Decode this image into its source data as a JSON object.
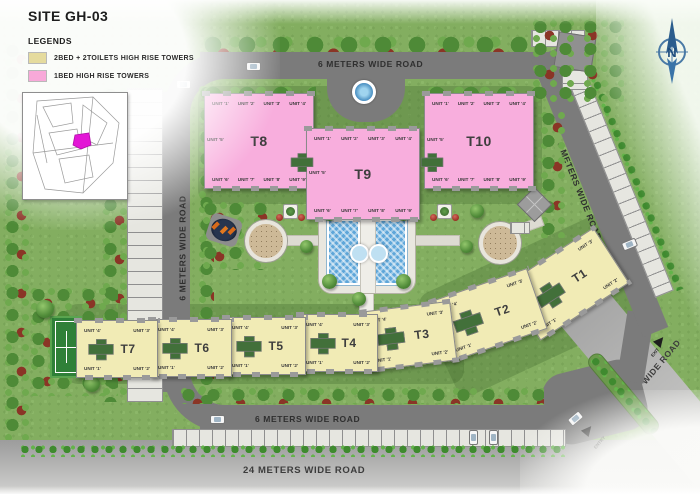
{
  "title": "SITE GH-03",
  "legend": {
    "heading": "LEGENDS",
    "items": [
      {
        "label": "2BED + 2TOILETS HIGH RISE TOWERS",
        "color": "#e5db9e"
      },
      {
        "label": "1BED  HIGH RISE TOWERS",
        "color": "#f8a9d9"
      }
    ]
  },
  "compass": {
    "label": "N"
  },
  "roads": {
    "top_label": "6 METERS WIDE ROAD",
    "left_label": "6 METERS WIDE ROAD",
    "right_label": "6 METERS WIDE ROAD",
    "inner_bottom_label": "6 METERS WIDE ROAD",
    "outer_bottom_label": "24 METERS WIDE ROAD",
    "outer_right_label": "24 METERS WIDE ROAD"
  },
  "gate": {
    "entry_label": "ENTRY",
    "exit_label": "EXIT"
  },
  "unit_labels": {
    "pink_top": [
      "UNIT '1'",
      "UNIT '2'",
      "UNIT '3'",
      "UNIT '4'"
    ],
    "pink_bottom": [
      "UNIT '6'",
      "UNIT '7'",
      "UNIT '8'",
      "UNIT '9'"
    ],
    "pink_side": "UNIT '5'",
    "yellow_top": [
      "UNIT '4'",
      "UNIT '3'"
    ],
    "yellow_bottom": [
      "UNIT '1'",
      "UNIT '2'"
    ]
  },
  "towers": {
    "pink": [
      {
        "id": "T8"
      },
      {
        "id": "T9"
      },
      {
        "id": "T10"
      }
    ],
    "yellow": [
      {
        "id": "T1"
      },
      {
        "id": "T2"
      },
      {
        "id": "T3"
      },
      {
        "id": "T4"
      },
      {
        "id": "T5"
      },
      {
        "id": "T6"
      },
      {
        "id": "T7"
      }
    ]
  },
  "colors": {
    "site_green": "#83ae60",
    "road_gray": "#7b7b7b",
    "wide_road_gray": "#b9b9b8",
    "pink_tower": "#f8aedd",
    "yellow_tower": "#f1ebb5",
    "water_blue": "#5ea6d9",
    "tennis_green": "#2f8038",
    "key_plan_highlight": "#e316d6",
    "compass_blue": "#2b5d8d"
  }
}
